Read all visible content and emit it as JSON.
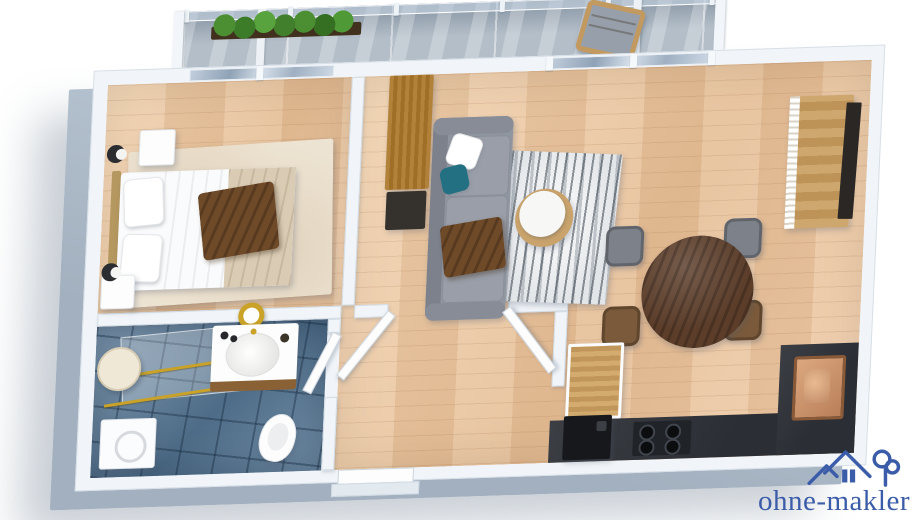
{
  "watermark": {
    "text": "ohne-makler",
    "icon": "house-with-tree-logo-icon",
    "color": "#3b5ca8"
  },
  "palette": {
    "background": "#ffffff",
    "wall_top": "#f1f5f9",
    "wall_edge": "#d4dde5",
    "wall_side": "#aebccb",
    "wood_floor": "#ecc9a6",
    "bathroom_tile": "#5f7f9c",
    "balcony_stone": "#a9b5c1",
    "window_glass": "#b9c8d8",
    "kitchen_counter": "#2b2e34",
    "copper_sink": "#c08a66",
    "sofa_gray": "#9096a0",
    "pillow_teal": "#227082",
    "throw_brown": "#6f4a28",
    "blanket_beige": "#d9cbb4",
    "bed_white": "#fafbfc",
    "rug_cream": "#ede3d2",
    "dining_wood": "#5b3d2a",
    "oak_wood": "#c1965a",
    "plant_green": "#4c8f33",
    "gold_accent": "#c9a227",
    "logo_blue": "#3b5ca8"
  },
  "scene": {
    "type": "3d-apartment-floor-plan-render",
    "rooms": [
      {
        "name": "balcony",
        "items": [
          "planter-with-plants",
          "wooden-chair",
          "glass-railing"
        ]
      },
      {
        "name": "bedroom",
        "items": [
          "double-bed",
          "headboard",
          "two-nightstands",
          "two-wall-lamps",
          "cream-rug"
        ]
      },
      {
        "name": "bathroom",
        "items": [
          "walk-in-shower",
          "round-mirror",
          "gold-mirror",
          "vanity-sink",
          "toilet",
          "washing-machine"
        ]
      },
      {
        "name": "hallway",
        "items": [
          "open-door-leaves",
          "entrance-door"
        ]
      },
      {
        "name": "living-room",
        "items": [
          "gray-sofa",
          "teal-pillow",
          "white-pillow",
          "brown-throw",
          "abstract-rug",
          "round-coffee-table",
          "wardrobe",
          "dark-lowboard"
        ]
      },
      {
        "name": "dining-area",
        "items": [
          "oval-wood-table",
          "two-gray-chairs",
          "two-brown-chairs",
          "wood-sideboard",
          "tv-panel"
        ]
      },
      {
        "name": "kitchen",
        "items": [
          "dark-counter",
          "gas-hob",
          "fridge",
          "copper-sink",
          "wood-cabinet"
        ]
      }
    ]
  }
}
